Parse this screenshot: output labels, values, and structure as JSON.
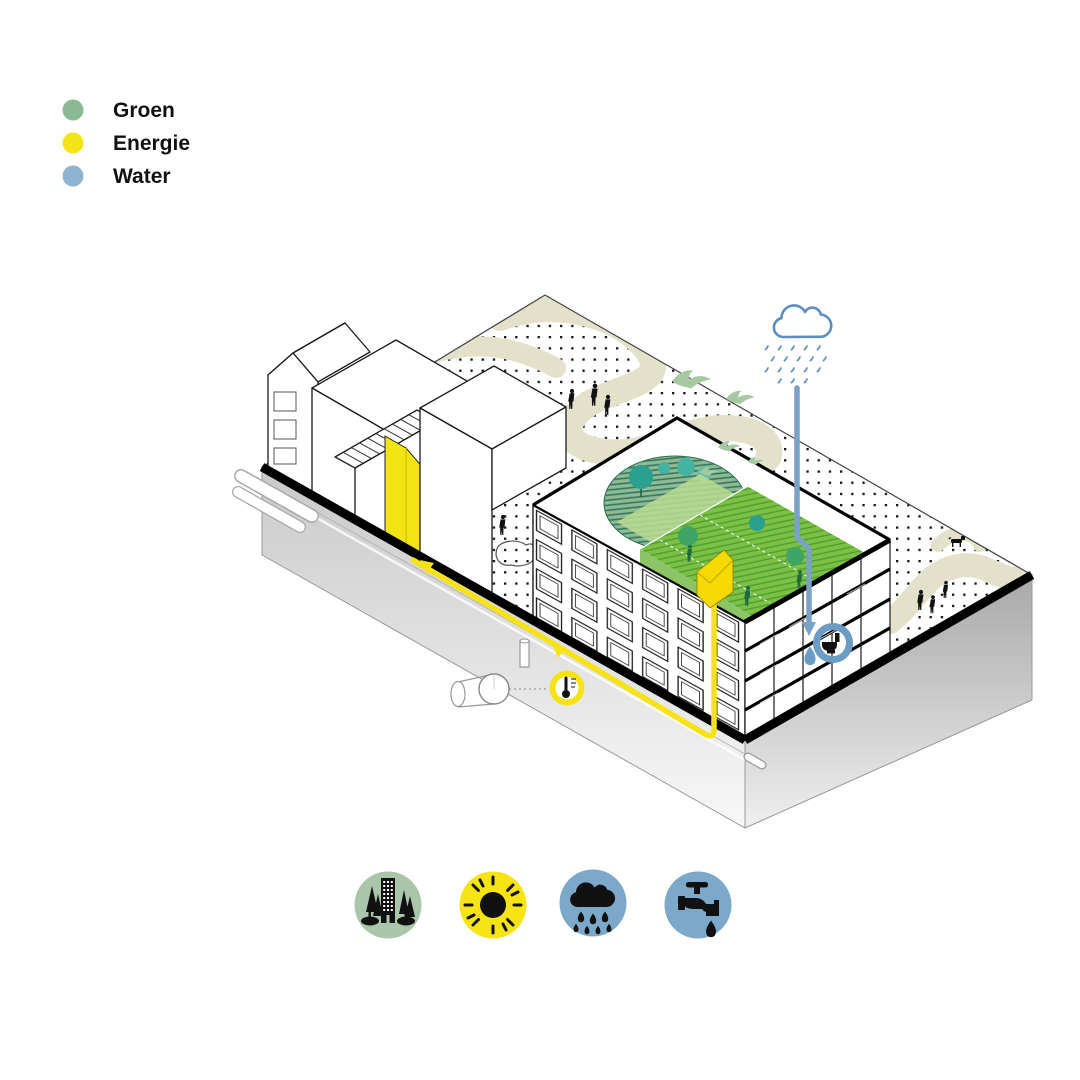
{
  "legend": {
    "items": [
      {
        "id": "groen",
        "label": "Groen",
        "color": "#8cb893"
      },
      {
        "id": "energie",
        "label": "Energie",
        "color": "#f5e31a"
      },
      {
        "id": "water",
        "label": "Water",
        "color": "#8fb4d1"
      }
    ]
  },
  "diagram": {
    "type": "isometric-urban-block-sustainability-scheme",
    "markers": [
      {
        "name": "rain-cloud-icon",
        "color": "#5c8ec2"
      },
      {
        "name": "rainwater-pipe",
        "color": "#7aa2c6"
      },
      {
        "name": "toilet-reuse-marker",
        "color": "#6b9cc3"
      },
      {
        "name": "water-drop-icon",
        "color": "#6b9cc3"
      },
      {
        "name": "energy-loop-line",
        "color": "#f6e215"
      },
      {
        "name": "thermometer-marker",
        "color": "#f6e215"
      },
      {
        "name": "green-roof-terraces",
        "color": "#7cc144"
      },
      {
        "name": "lawn-ellipse",
        "color": "#93b896"
      },
      {
        "name": "courtyard-paths",
        "color": "#e4e1ca"
      }
    ]
  },
  "footer_icons": [
    {
      "name": "city-trees-icon",
      "bg": "#a9c6aa"
    },
    {
      "name": "sun-icon",
      "bg": "#f8e414"
    },
    {
      "name": "rain-cloud-icon",
      "bg": "#7ca9ca"
    },
    {
      "name": "water-tap-icon",
      "bg": "#7ca9ca"
    }
  ]
}
